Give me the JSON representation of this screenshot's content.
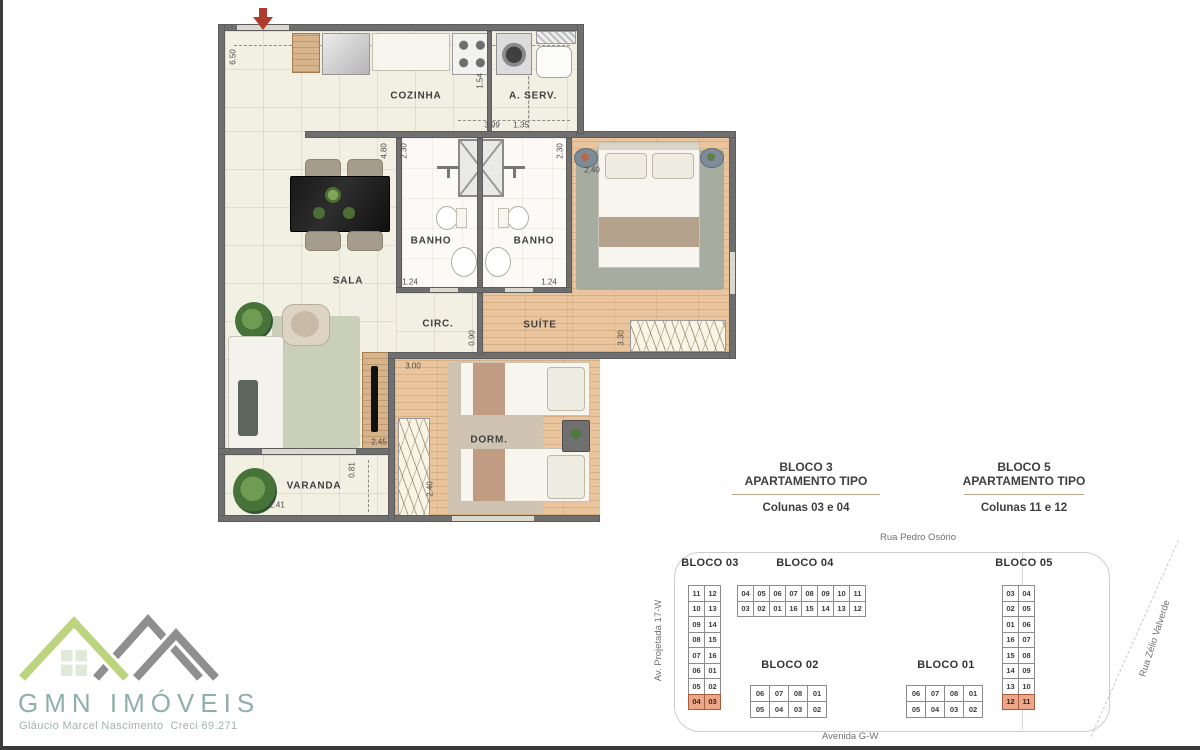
{
  "floorplan": {
    "rooms": [
      {
        "text": "COZINHA",
        "x": 416,
        "y": 96,
        "rot": 0
      },
      {
        "text": "A. SERV.",
        "x": 533,
        "y": 96,
        "rot": 0
      },
      {
        "text": "BANHO",
        "x": 431,
        "y": 241,
        "rot": 0
      },
      {
        "text": "BANHO",
        "x": 534,
        "y": 241,
        "rot": 0
      },
      {
        "text": "SALA",
        "x": 348,
        "y": 281,
        "rot": 0
      },
      {
        "text": "CIRC.",
        "x": 438,
        "y": 324,
        "rot": 0
      },
      {
        "text": "SUÍTE",
        "x": 540,
        "y": 325,
        "rot": 0
      },
      {
        "text": "DORM.",
        "x": 489,
        "y": 440,
        "rot": 0
      },
      {
        "text": "VARANDA",
        "x": 314,
        "y": 486,
        "rot": 0
      }
    ],
    "measurements": [
      {
        "text": "6.50",
        "x": 233,
        "y": 57,
        "rot": -90
      },
      {
        "text": "1.54",
        "x": 480,
        "y": 81,
        "rot": -90
      },
      {
        "text": "3.99",
        "x": 492,
        "y": 125,
        "rot": 0
      },
      {
        "text": "1.35",
        "x": 521,
        "y": 125,
        "rot": 0
      },
      {
        "text": "4.80",
        "x": 384,
        "y": 151,
        "rot": -90
      },
      {
        "text": "2.30",
        "x": 404,
        "y": 151,
        "rot": -90
      },
      {
        "text": "2.30",
        "x": 560,
        "y": 151,
        "rot": -90
      },
      {
        "text": "2.40",
        "x": 592,
        "y": 170,
        "rot": 0
      },
      {
        "text": "1.24",
        "x": 410,
        "y": 282,
        "rot": 0
      },
      {
        "text": "1.24",
        "x": 549,
        "y": 282,
        "rot": 0
      },
      {
        "text": "0.90",
        "x": 472,
        "y": 338,
        "rot": -90
      },
      {
        "text": "3.30",
        "x": 621,
        "y": 338,
        "rot": -90
      },
      {
        "text": "3.00",
        "x": 413,
        "y": 366,
        "rot": 0
      },
      {
        "text": "2.45",
        "x": 379,
        "y": 442,
        "rot": 0
      },
      {
        "text": "2.40",
        "x": 430,
        "y": 489,
        "rot": -90
      },
      {
        "text": "0.81",
        "x": 352,
        "y": 470,
        "rot": -90
      },
      {
        "text": "2.41",
        "x": 277,
        "y": 505,
        "rot": 0
      }
    ]
  },
  "legend": {
    "left": {
      "line1": "BLOCO 3",
      "line2": "APARTAMENTO TIPO",
      "line3": "Colunas 03 e 04"
    },
    "right": {
      "line1": "BLOCO 5",
      "line2": "APARTAMENTO TIPO",
      "line3": "Colunas 11 e 12"
    }
  },
  "site_plan": {
    "streets": {
      "top": "Rua Pedro Osório",
      "bottom": "Avenida G-W",
      "left": "Av. Projetada 17-W",
      "right": "Rua Zélio Valverde"
    },
    "blocks": [
      {
        "id": "bloco03",
        "title": "BLOCO 03",
        "cell_class": "v-cell",
        "highlight_row": 7,
        "rows": [
          [
            "11",
            "12"
          ],
          [
            "10",
            "13"
          ],
          [
            "09",
            "14"
          ],
          [
            "08",
            "15"
          ],
          [
            "07",
            "16"
          ],
          [
            "06",
            "01"
          ],
          [
            "05",
            "02"
          ],
          [
            "04",
            "03"
          ]
        ]
      },
      {
        "id": "bloco04",
        "title": "BLOCO 04",
        "cell_class": "h-cell",
        "highlight_row": -1,
        "rows": [
          [
            "04",
            "05",
            "06",
            "07",
            "08",
            "09",
            "10",
            "11"
          ],
          [
            "03",
            "02",
            "01",
            "16",
            "15",
            "14",
            "13",
            "12"
          ]
        ]
      },
      {
        "id": "bloco02",
        "title": "BLOCO 02",
        "cell_class": "b2-cell",
        "highlight_row": -1,
        "rows": [
          [
            "06",
            "07",
            "08",
            "01"
          ],
          [
            "05",
            "04",
            "03",
            "02"
          ]
        ]
      },
      {
        "id": "bloco01",
        "title": "BLOCO 01",
        "cell_class": "b2-cell",
        "highlight_row": -1,
        "rows": [
          [
            "06",
            "07",
            "08",
            "01"
          ],
          [
            "05",
            "04",
            "03",
            "02"
          ]
        ]
      },
      {
        "id": "bloco05",
        "title": "BLOCO 05",
        "cell_class": "v-cell",
        "highlight_row": 7,
        "rows": [
          [
            "03",
            "04"
          ],
          [
            "02",
            "05"
          ],
          [
            "01",
            "06"
          ],
          [
            "16",
            "07"
          ],
          [
            "15",
            "08"
          ],
          [
            "14",
            "09"
          ],
          [
            "13",
            "10"
          ],
          [
            "12",
            "11"
          ]
        ]
      }
    ]
  },
  "logo": {
    "name": "GMN IMÓVEIS",
    "subtitle": "Gláucio Marcel Nascimento  Creci 69.271"
  }
}
